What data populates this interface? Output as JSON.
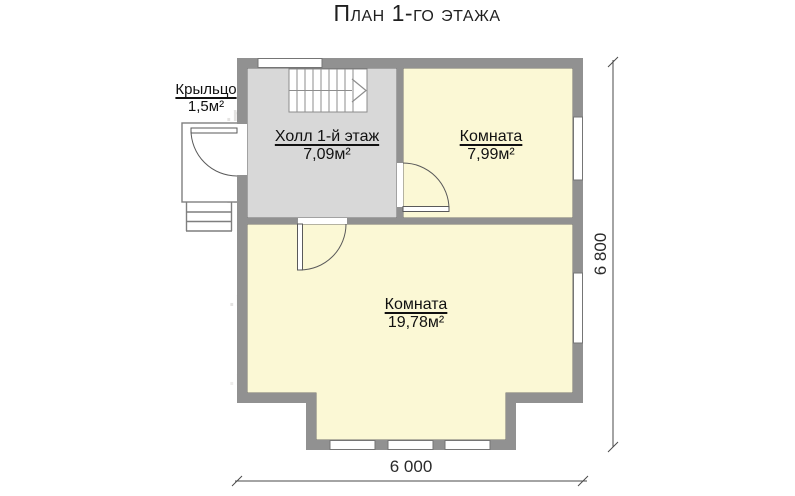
{
  "title": "План 1-го этажа",
  "rooms": {
    "porch": {
      "name": "Крыльцо",
      "area": "1,5м²"
    },
    "hall": {
      "name": "Холл 1-й этаж",
      "area": "7,09м²"
    },
    "room_top": {
      "name": "Комната",
      "area": "7,99м²"
    },
    "room_big": {
      "name": "Комната",
      "area": "19,78м²"
    }
  },
  "dimensions": {
    "overall_width": "6 000",
    "overall_height": "6 800"
  },
  "watermark": {
    "fragment_left": ".ru",
    "fragment_right": "www.z"
  },
  "colors": {
    "wall_fill": "#919191",
    "wall_outline": "#6d6d6d",
    "hall_fill": "#d8d8d8",
    "room_fill": "#fbf8d5",
    "dimension_line": "#4a4a4a"
  }
}
